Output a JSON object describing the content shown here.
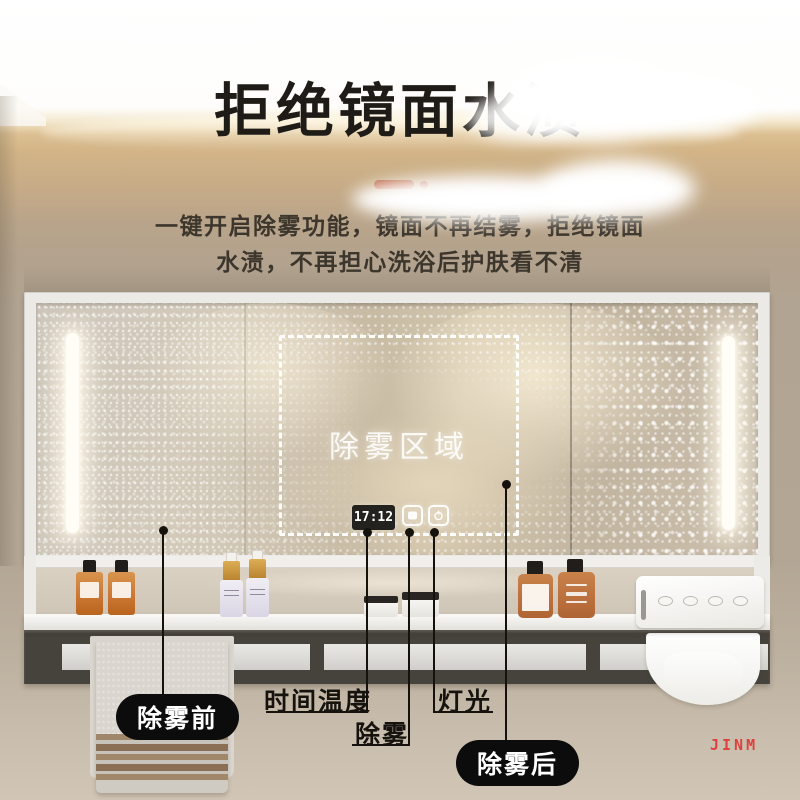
{
  "header": {
    "title": "拒绝镜面水渍",
    "subtitle_line1": "一键开启除雾功能，镜面不再结雾，拒绝镜面",
    "subtitle_line2": "水渍，不再担心洗浴后护肤看不清",
    "accent_color": "#b85e3a"
  },
  "mirror": {
    "defog_zone_label": "除雾区域",
    "clock_time": "17:12",
    "icons": [
      "defog-icon",
      "power-icon"
    ]
  },
  "callouts": {
    "before_label": "除雾前",
    "time_temp_label": "时间温度",
    "defog_label": "除雾",
    "light_label": "灯光",
    "after_label": "除雾后"
  },
  "watermark": "JINM",
  "colors": {
    "accent": "#b85e3a",
    "callout_label_bg": "#0c0c0c",
    "watermark_red": "#df403c",
    "wall_tan": "#c6ab87",
    "rack_dark": "#46423c"
  }
}
